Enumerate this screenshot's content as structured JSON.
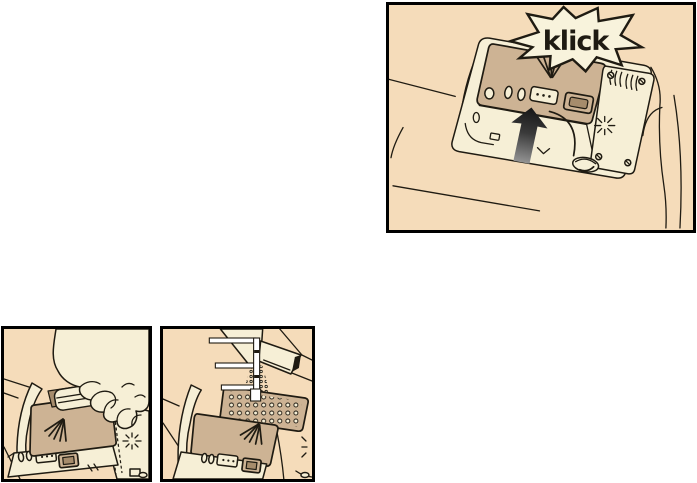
{
  "document": {
    "type": "appliance-manual-illustration-page"
  },
  "figures": {
    "top": {
      "name": "close-dispenser-lid",
      "callout_label": "klick"
    },
    "bottom_left": {
      "name": "insert-detergent-tab"
    },
    "bottom_right": {
      "name": "pour-detergent-powder"
    }
  },
  "colors": {
    "page_background": "#ffffff",
    "frame": "#000000",
    "outline": "#1f1b12",
    "tan": "#f5dcba",
    "cream": "#f6efd6",
    "burst": "#f8f3dc",
    "lid": "#cdb394",
    "lid_dark": "#a68c6c",
    "arrow_dark": "#141414",
    "arrow_light": "#a0a0a0"
  }
}
